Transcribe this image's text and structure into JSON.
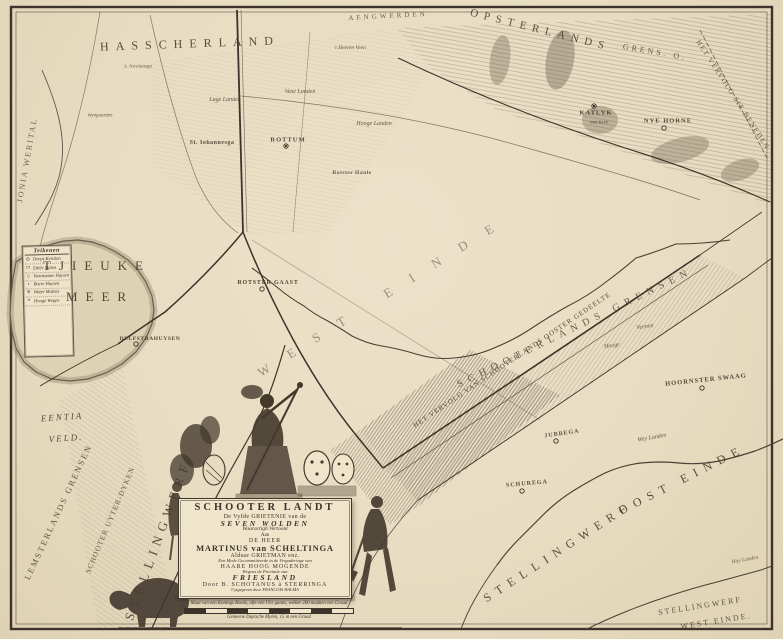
{
  "page": {
    "title": "Schooter Landt — De Vyfde Grietenije van de Seven Wolden"
  },
  "colors": {
    "paper": "#e8ddc2",
    "ink": "#3c332a",
    "hatch": "#4b4132",
    "water_edge": "#6b5f4b",
    "plaque": "#efe5cb"
  },
  "legend": {
    "header": "Teikenen",
    "entries": [
      {
        "mark": "⊙",
        "label": "Dorps Kercken"
      },
      {
        "mark": "▭",
        "label": "Edele Staten"
      },
      {
        "mark": "⌂",
        "label": "Voornaame Huysen"
      },
      {
        "mark": "•",
        "label": "Boere Huysen"
      },
      {
        "mark": "✳",
        "label": "Water Molens"
      },
      {
        "mark": "≡",
        "label": "Hooge Wegen"
      }
    ]
  },
  "cartouche": {
    "lines": [
      {
        "text": "SCHOOTER LANDT",
        "cls": "c-title"
      },
      {
        "text": "De Vyfde GRIETENIE van de",
        "cls": "c-sub"
      },
      {
        "text": "SEVEN WOLDEN",
        "cls": "c-ital"
      },
      {
        "text": "Waaractigh Vertoont",
        "cls": "c-si"
      },
      {
        "text": "Aan",
        "cls": "c-tiny"
      },
      {
        "text": "DE HEER",
        "cls": "c-sc"
      },
      {
        "text": "MARTINUS van SCHELTINGA",
        "cls": "c-name"
      },
      {
        "text": "Alduar GRIETMAN enz.",
        "cls": "c-sub"
      },
      {
        "text": "Een Mede Gecommitteerde in de Vergaderinge van",
        "cls": "c-ti"
      },
      {
        "text": "HAARE HOOG MOGENDE",
        "cls": "c-sc"
      },
      {
        "text": "Wegens de Provintie van",
        "cls": "c-ti"
      },
      {
        "text": "FRIESLAND",
        "cls": "c-ital"
      },
      {
        "text": "Door B. SCHOTANUS à STERRINGA",
        "cls": "c-sc"
      },
      {
        "text": "Uytgegeven door FRANCOIS HALMA",
        "cls": "c-micro"
      }
    ]
  },
  "scale": {
    "line1": "Maat van een Konings Roede, ofte een Uhr gaans, welker 200 maaken een Graad",
    "line2": "Gemeene Duytsche Mylen, 15 in een Graad",
    "segments": 8
  },
  "map": {
    "labels": [
      {
        "t": "HASSCHERLAND",
        "x": 190,
        "y": 44,
        "r": -2,
        "fs": 12,
        "ls": 7,
        "cls": "reg",
        "op": 0.9
      },
      {
        "t": "AENGWERDEN",
        "x": 388,
        "y": 16,
        "r": -3,
        "fs": 7,
        "ls": 3,
        "cls": "reg",
        "op": 0.8
      },
      {
        "t": "OPSTERLANDS",
        "x": 540,
        "y": 30,
        "r": 14,
        "fs": 11,
        "ls": 6,
        "cls": "reg",
        "op": 0.9
      },
      {
        "t": "GRENS. O.",
        "x": 655,
        "y": 52,
        "r": 10,
        "fs": 8,
        "ls": 3,
        "cls": "reg",
        "op": 0.85
      },
      {
        "t": "HET VERVOLG SIE BENEDEN",
        "x": 733,
        "y": 95,
        "r": 57,
        "fs": 7,
        "ls": 1.5,
        "cls": "reg",
        "op": 0.85
      },
      {
        "t": "TJIEUKE",
        "x": 97,
        "y": 266,
        "r": 0,
        "fs": 13,
        "ls": 8,
        "cls": "reg",
        "op": 0.95
      },
      {
        "t": "MEER",
        "x": 100,
        "y": 297,
        "r": 0,
        "fs": 13,
        "ls": 8,
        "cls": "reg",
        "op": 0.95
      },
      {
        "t": "EENTIA",
        "x": 62,
        "y": 417,
        "r": -4,
        "fs": 9,
        "ls": 2,
        "cls": "fld",
        "op": 0.9
      },
      {
        "t": "VELD.",
        "x": 66,
        "y": 438,
        "r": -4,
        "fs": 9,
        "ls": 2,
        "cls": "fld",
        "op": 0.9
      },
      {
        "t": "LEMSTERLANDS GRENSEN",
        "x": 58,
        "y": 512,
        "r": -65,
        "fs": 8.5,
        "ls": 2,
        "cls": "reg",
        "op": 0.85
      },
      {
        "t": "SCHOOTER UYTER-DYKEN",
        "x": 110,
        "y": 520,
        "r": -67,
        "fs": 7.5,
        "ls": 1,
        "cls": "reg",
        "op": 0.8
      },
      {
        "t": "STELLINGWERF",
        "x": 158,
        "y": 540,
        "r": -70,
        "fs": 13,
        "ls": 6,
        "cls": "reg",
        "op": 0.9
      },
      {
        "t": "JONIA WERITAL",
        "x": 27,
        "y": 160,
        "r": -80,
        "fs": 8,
        "ls": 2,
        "cls": "reg",
        "op": 0.75
      },
      {
        "t": "HET VERVOLG VAN SCHOOTERLANDS OOSTER GEDEELTE",
        "x": 512,
        "y": 360,
        "r": -34,
        "fs": 7,
        "ls": 1,
        "cls": "reg",
        "op": 0.9
      },
      {
        "t": "SCHOOTERLANDS GRENSEN",
        "x": 575,
        "y": 328,
        "r": -26,
        "fs": 10,
        "ls": 6,
        "cls": "reg",
        "op": 0.8
      },
      {
        "t": "WEST EINDE",
        "x": 385,
        "y": 295,
        "r": -32,
        "fs": 13,
        "ls": 22,
        "cls": "reg",
        "op": 0.5
      },
      {
        "t": "STELLINGWERF",
        "x": 558,
        "y": 552,
        "r": -33,
        "fs": 12,
        "ls": 7,
        "cls": "reg",
        "op": 0.9
      },
      {
        "t": "OOST EINDE",
        "x": 682,
        "y": 480,
        "r": -27,
        "fs": 12,
        "ls": 7,
        "cls": "reg",
        "op": 0.9
      },
      {
        "t": "STELLINGWERF",
        "x": 700,
        "y": 606,
        "r": -9,
        "fs": 8,
        "ls": 2,
        "cls": "reg",
        "op": 0.85
      },
      {
        "t": "WEST EINDE.",
        "x": 716,
        "y": 621,
        "r": -9,
        "fs": 8,
        "ls": 2,
        "cls": "reg",
        "op": 0.85
      },
      {
        "t": "HOORNSTER SWAAG",
        "x": 706,
        "y": 380,
        "r": -6,
        "fs": 6.5,
        "ls": 1,
        "cls": "vil",
        "op": 0.95
      },
      {
        "t": "ROTTUM",
        "x": 288,
        "y": 140,
        "r": 0,
        "fs": 6.5,
        "ls": 1,
        "cls": "vil",
        "op": 0.95
      },
      {
        "t": "St. Iohannesga",
        "x": 212,
        "y": 143,
        "r": 0,
        "fs": 6,
        "ls": 0.5,
        "cls": "vil",
        "op": 0.9
      },
      {
        "t": "Rotster Haule",
        "x": 352,
        "y": 173,
        "r": 0,
        "fs": 5.5,
        "ls": 0.5,
        "cls": "vil",
        "op": 0.85
      },
      {
        "t": "ROTSTER GAAST",
        "x": 268,
        "y": 283,
        "r": 0,
        "fs": 6,
        "ls": 0.8,
        "cls": "vil",
        "op": 0.95
      },
      {
        "t": "DELFSTRAHUYSEN",
        "x": 150,
        "y": 339,
        "r": 0,
        "fs": 5.5,
        "ls": 0.6,
        "cls": "vil",
        "op": 0.95
      },
      {
        "t": "KATLYK",
        "x": 596,
        "y": 113,
        "r": 0,
        "fs": 6.5,
        "ls": 1,
        "cls": "vil",
        "op": 0.95
      },
      {
        "t": "met Kerk",
        "x": 599,
        "y": 123,
        "r": 0,
        "fs": 4.8,
        "ls": 0,
        "cls": "fld",
        "op": 0.9
      },
      {
        "t": "NYE HORNE",
        "x": 668,
        "y": 121,
        "r": 0,
        "fs": 6.5,
        "ls": 1,
        "cls": "vil",
        "op": 0.95
      },
      {
        "t": "JUBBEGA",
        "x": 562,
        "y": 434,
        "r": -8,
        "fs": 6,
        "ls": 1,
        "cls": "vil",
        "op": 0.9
      },
      {
        "t": "SCHUREGA",
        "x": 527,
        "y": 484,
        "r": -5,
        "fs": 6,
        "ls": 1,
        "cls": "vil",
        "op": 0.9
      },
      {
        "t": "'t Heeren Veen",
        "x": 350,
        "y": 48,
        "r": 0,
        "fs": 5.5,
        "ls": 0,
        "cls": "fld",
        "op": 0.9
      },
      {
        "t": "Vene Landen",
        "x": 300,
        "y": 92,
        "r": 0,
        "fs": 6,
        "ls": 0,
        "cls": "fld",
        "op": 0.85
      },
      {
        "t": "Hooge Landen",
        "x": 374,
        "y": 124,
        "r": 0,
        "fs": 6,
        "ls": 0,
        "cls": "fld",
        "op": 0.85
      },
      {
        "t": "Lage Landen",
        "x": 225,
        "y": 100,
        "r": 0,
        "fs": 6,
        "ls": 0,
        "cls": "fld",
        "op": 0.85
      },
      {
        "t": "Veenen",
        "x": 645,
        "y": 327,
        "r": -8,
        "fs": 6,
        "ls": 0,
        "cls": "fld",
        "op": 0.85
      },
      {
        "t": "Hooge",
        "x": 612,
        "y": 346,
        "r": -8,
        "fs": 6,
        "ls": 0,
        "cls": "fld",
        "op": 0.85
      },
      {
        "t": "Wey Landen",
        "x": 652,
        "y": 438,
        "r": -10,
        "fs": 6,
        "ls": 0,
        "cls": "fld",
        "op": 0.85
      },
      {
        "t": "Hoy Landen",
        "x": 745,
        "y": 560,
        "r": -10,
        "fs": 5.5,
        "ls": 0,
        "cls": "fld",
        "op": 0.8
      },
      {
        "t": "S. Nicolaasga",
        "x": 138,
        "y": 67,
        "r": 0,
        "fs": 5,
        "ls": 0,
        "cls": "fld",
        "op": 0.85
      },
      {
        "t": "Wyngaarden",
        "x": 100,
        "y": 116,
        "r": 0,
        "fs": 5,
        "ls": 0,
        "cls": "fld",
        "op": 0.85
      }
    ]
  }
}
